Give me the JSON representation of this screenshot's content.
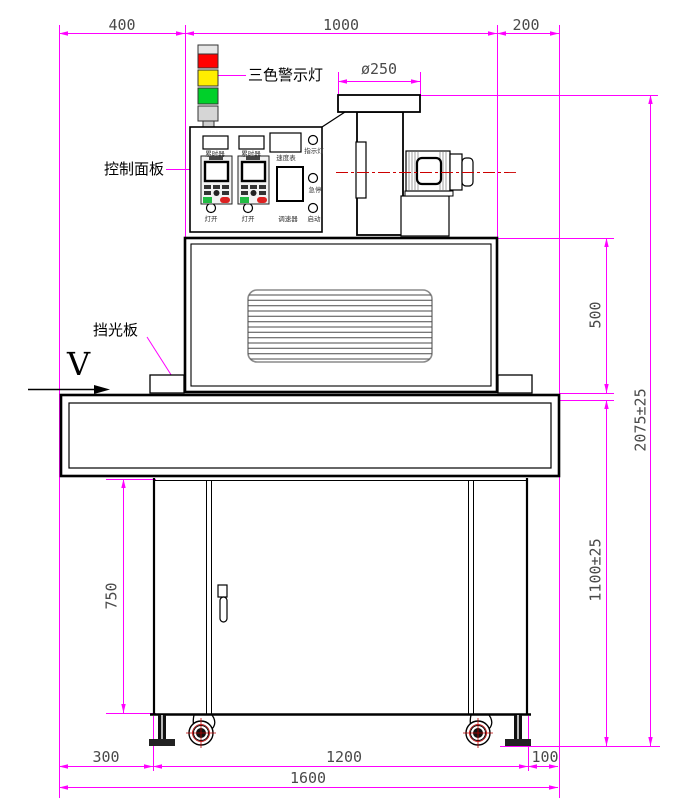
{
  "title": "UV curing machine front-view dimension drawing",
  "callouts": {
    "warning_light": "三色警示灯",
    "control_panel": "控制面板",
    "light_shield": "挡光板",
    "direction": "V"
  },
  "panel_labels": {
    "timer_left": "累时器",
    "timer_right": "累时器",
    "speed_meter": "速度表",
    "indicator_light": "指示灯",
    "lamp_switch_left": "灯开",
    "lamp_switch_right": "灯开",
    "speed_governor": "调速器",
    "emergency_stop": "急停",
    "start": "启动"
  },
  "dimensions": {
    "top_left": "400",
    "top_middle": "1000",
    "top_right": "200",
    "duct_diameter": "ø250",
    "oven_height": "500",
    "overall_height": "2075±25",
    "table_height": "1100±25",
    "cabinet_height": "750",
    "bottom_left_offset": "300",
    "wheelbase": "1200",
    "bottom_right_offset": "100",
    "total_width": "1600"
  },
  "colors": {
    "dimension_line": "#ff00ff",
    "dimension_text": "#4a4a4a",
    "centerline_red": "#cc0000",
    "tower_red": "#ff0000",
    "tower_yellow": "#ffee00",
    "tower_green": "#00d02a"
  }
}
